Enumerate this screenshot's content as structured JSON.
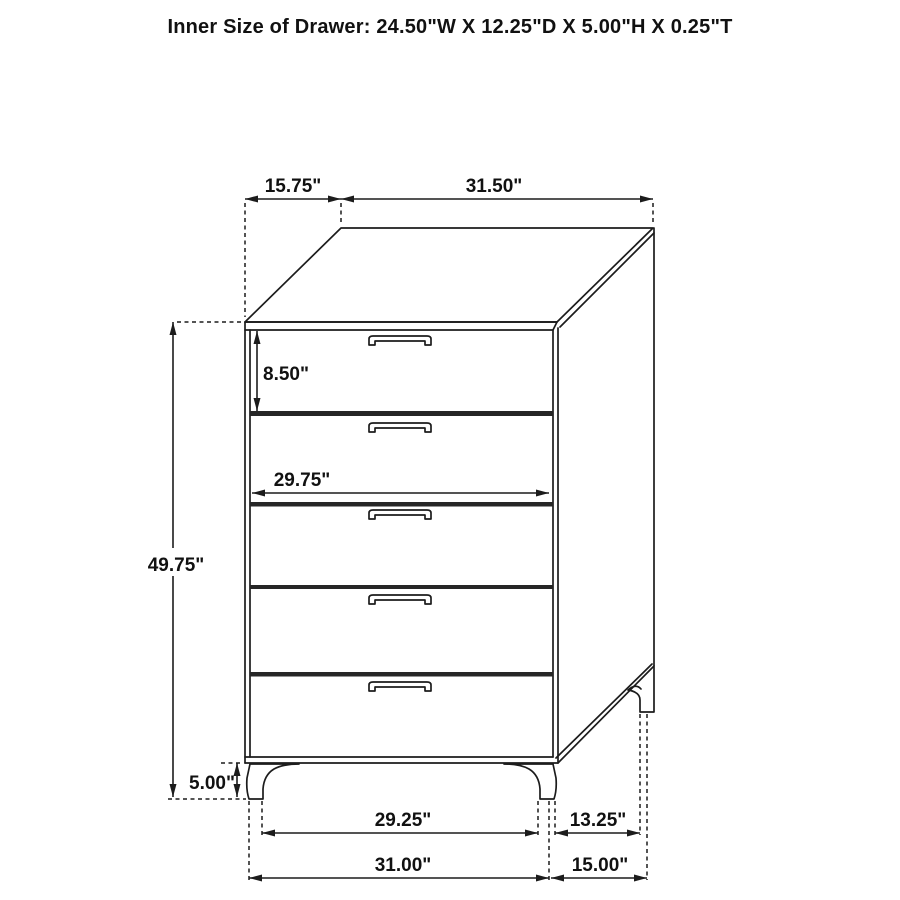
{
  "title": "Inner Size of Drawer: 24.50\"W X 12.25\"D X 5.00\"H X 0.25\"T",
  "figure": {
    "type": "furniture-dimension-diagram",
    "item": "5-drawer chest",
    "drawer_count": 5
  },
  "dimensions": {
    "top_depth": "15.75\"",
    "top_width": "31.50\"",
    "top_drawer_height": "8.50\"",
    "drawer_front_width": "29.75\"",
    "overall_height": "49.75\"",
    "leg_height": "5.00\"",
    "front_feet_inner_span": "29.25\"",
    "front_feet_outer_span": "31.00\"",
    "side_feet_inner_span": "13.25\"",
    "side_feet_outer_span": "15.00\""
  },
  "colors": {
    "line": "#1c1c1c",
    "background": "#ffffff"
  }
}
